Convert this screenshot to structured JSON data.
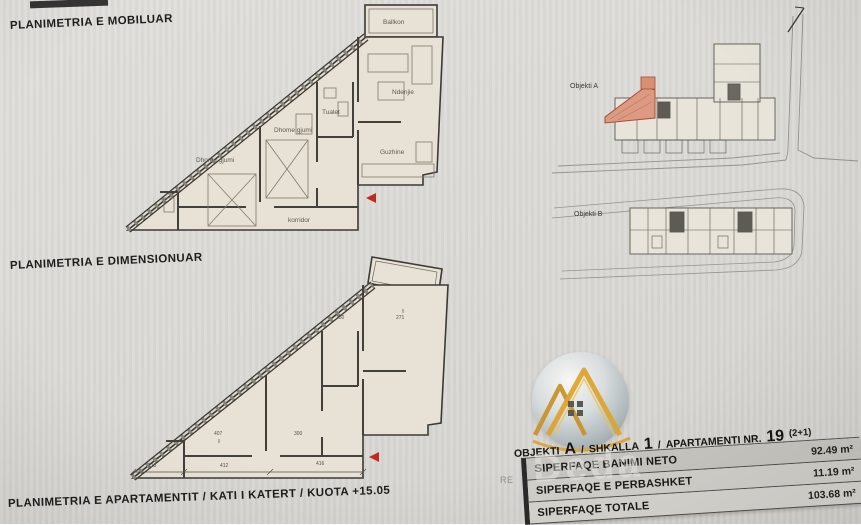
{
  "headings": {
    "furnished": "PLANIMETRIA E MOBILUAR",
    "dimensioned": "PLANIMETRIA E DIMENSIONUAR",
    "apartment": "PLANIMETRIA E APARTAMENTIT  /  KATI I KATERT  /  KUOTA +15.05"
  },
  "plan_furnished": {
    "label_balcony": "Ballkon",
    "label_living": "Ndenjie",
    "label_toilet": "Tualet",
    "label_bedroom1": "Dhome gjumi",
    "label_bedroom2": "Dhome gjumi",
    "label_kitchen": "Guzhine",
    "label_corridor": "korridor"
  },
  "plan_dimensioned": {
    "dims": {
      "d218": "218",
      "d412": "412",
      "d416": "416",
      "d407": "407",
      "d300": "300",
      "d271": "271",
      "d150": "150"
    }
  },
  "site_plan": {
    "objekti_a_label": "Objekti A",
    "objekti_b_label": "Objekti B"
  },
  "summary_card": {
    "header": {
      "objekti": "OBJEKTI",
      "objekti_val": "A",
      "sep1": "/",
      "shkalla": "SHKALLA",
      "shkalla_val": "1",
      "sep2": "/",
      "apartamenti": "APARTAMENTI NR.",
      "apartamenti_val": "19",
      "unit_type": "(2+1)"
    },
    "rows": [
      {
        "label": "SIPERFAQE BANIMI NETO",
        "value": "92.49 m²"
      },
      {
        "label": "SIPERFAQE E PERBASHKET",
        "value": "11.19 m²"
      },
      {
        "label": "SIPERFAQE TOTALE",
        "value": "103.68 m²"
      }
    ]
  },
  "watermark": {
    "brand": "Deda",
    "side_text": "RE"
  },
  "colors": {
    "highlight_unit": "#dd9a82",
    "gold": "#d9a02c",
    "paper": "#dbdad6",
    "plan_fill": "#e8e1d5"
  }
}
